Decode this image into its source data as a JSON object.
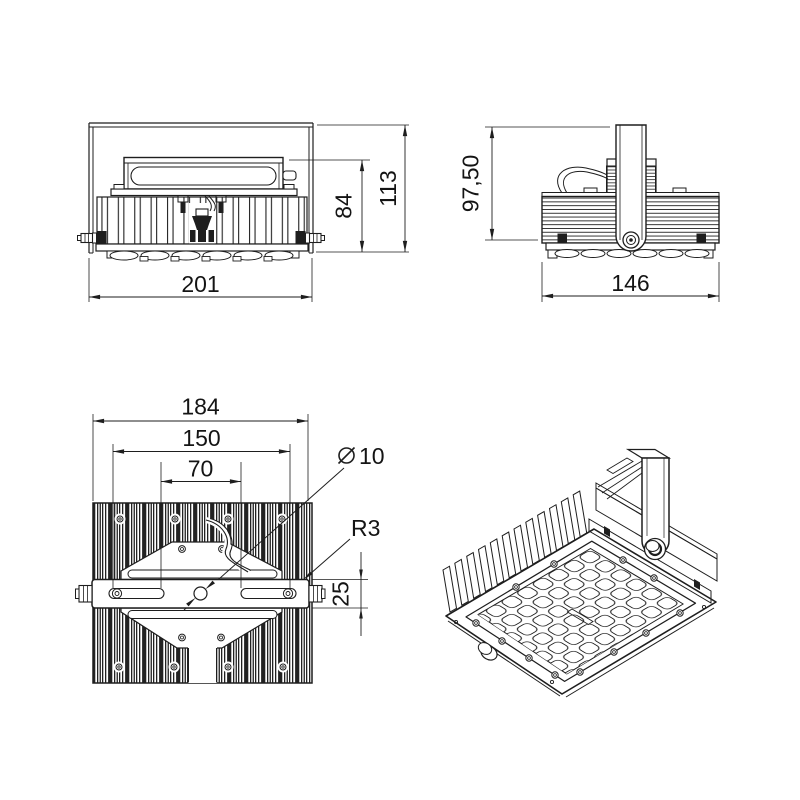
{
  "drawing": {
    "background": "#ffffff",
    "line_color": "#1e1e1e",
    "views": {
      "front": {
        "dims": {
          "width": "201",
          "body_height": "84",
          "total_height": "113"
        }
      },
      "side": {
        "dims": {
          "height_to_bracket": "97,50",
          "depth": "146"
        }
      },
      "top": {
        "dims": {
          "bracket_length": "184",
          "slot_span": "150",
          "slot_inner_span": "70",
          "hole_diameter_symbol": "⌀",
          "hole_diameter": "10",
          "corner_radius": "R3",
          "bracket_width": "25"
        }
      }
    }
  }
}
